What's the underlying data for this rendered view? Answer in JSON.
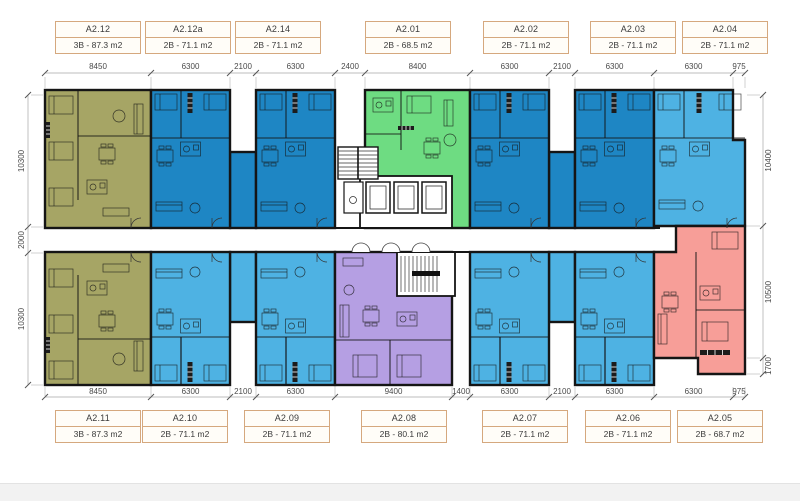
{
  "units_top": [
    {
      "id": "A2.12",
      "spec": "3B - 87.3 m2",
      "color": "olive"
    },
    {
      "id": "A2.12a",
      "spec": "2B - 71.1 m2",
      "color": "blue_dark"
    },
    {
      "id": "A2.14",
      "spec": "2B - 71.1 m2",
      "color": "blue_dark"
    },
    {
      "id": "A2.01",
      "spec": "2B - 68.5 m2",
      "color": "green"
    },
    {
      "id": "A2.02",
      "spec": "2B - 71.1 m2",
      "color": "blue_dark"
    },
    {
      "id": "A2.03",
      "spec": "2B - 71.1 m2",
      "color": "blue_dark"
    },
    {
      "id": "A2.04",
      "spec": "2B - 71.1 m2",
      "color": "blue_light"
    }
  ],
  "units_bottom": [
    {
      "id": "A2.11",
      "spec": "3B - 87.3 m2",
      "color": "olive"
    },
    {
      "id": "A2.10",
      "spec": "2B - 71.1 m2",
      "color": "blue_light"
    },
    {
      "id": "A2.09",
      "spec": "2B - 71.1 m2",
      "color": "blue_light"
    },
    {
      "id": "A2.08",
      "spec": "2B - 80.1 m2",
      "color": "purple"
    },
    {
      "id": "A2.07",
      "spec": "2B - 71.1 m2",
      "color": "blue_light"
    },
    {
      "id": "A2.06",
      "spec": "2B - 71.1 m2",
      "color": "blue_light"
    },
    {
      "id": "A2.05",
      "spec": "2B - 68.7 m2",
      "color": "salmon"
    }
  ],
  "dimensions": {
    "top": [
      "8450",
      "6300",
      "2100",
      "6300",
      "2400",
      "8400",
      "6300",
      "2100",
      "6300",
      "6300",
      "975"
    ],
    "bottom": [
      "8450",
      "6300",
      "2100",
      "6300",
      "9400",
      "1400",
      "6300",
      "2100",
      "6300",
      "6300",
      "975"
    ],
    "left": [
      "10300",
      "2000",
      "10300"
    ],
    "right": [
      "10400",
      "10500",
      "1700"
    ]
  },
  "colors": {
    "olive": "#a6a565",
    "blue_dark": "#1e86c4",
    "blue_light": "#4eb2e3",
    "green": "#6edc82",
    "purple": "#b59fe3",
    "salmon": "#f79e98",
    "wall": "#151515",
    "label_border": "#d5a87e",
    "dim_line": "#bcbcbc",
    "dim_text": "#4a4a4a",
    "footer_bar": "#f2f2f2"
  }
}
